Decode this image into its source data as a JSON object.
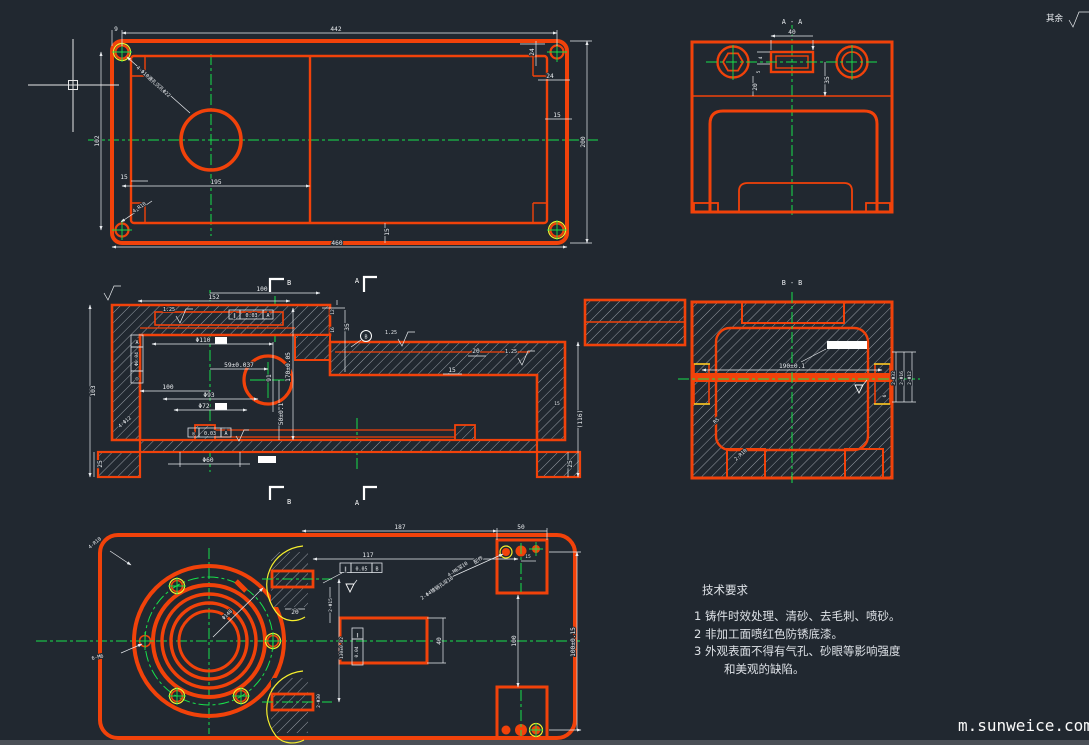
{
  "colors": {
    "background": "#212830",
    "line_orange": "#f1420a",
    "centerline_green": "#17e14b",
    "highlight_yellow": "#f6ef2d",
    "dimension_white": "#e9ecef"
  },
  "corner_note": {
    "text": "其余"
  },
  "watermark": {
    "text": "m.sunweice.com"
  },
  "tech": {
    "title": "技术要求",
    "line1": "1  铸件时效处理、清砂、去毛刺、喷砂。",
    "line2": "2  非加工面喷红色防锈底漆。",
    "line3": "3  外观表面不得有气孔、砂眼等影响强度",
    "line4": "和美观的缺陷。"
  },
  "top": {
    "d442": "442",
    "d9": "9",
    "d24a": "24",
    "d24b": "24",
    "d15r": "15",
    "d200": "200",
    "d102": "102",
    "d15l": "15",
    "d195": "195",
    "d460": "460",
    "d15b": "15",
    "leader_holes": "4-Φ10通孔沉孔Φ22",
    "leader_corner": "4-R10"
  },
  "front": {
    "d100t": "100",
    "d152": "152",
    "sf1": "1.25",
    "sf2": "1.25",
    "sf3": "1.25",
    "gdt_top": {
      "sym": "∥",
      "val": "0.03",
      "ref": "A"
    },
    "gdt_left": {
      "sym": "◎",
      "val": "Φ0.04",
      "ref": "A"
    },
    "gdt_bot": {
      "sym": "◎",
      "val": "0.03",
      "ref": "A"
    },
    "d110": "Φ110",
    "d59": "59±0.037",
    "d91": "91",
    "d170": "170±0.05",
    "d100m": "100",
    "d93": "Φ93",
    "d72": "Φ72",
    "d50": "50±0.1",
    "d60": "Φ60",
    "d103": "103",
    "d25l": "25",
    "leader_left": "4-Φ12",
    "d20": "20",
    "d15": "15",
    "d116": "(116)",
    "d15s": "15",
    "d25r": "25",
    "d12": "12",
    "d16": "16",
    "d35": "35",
    "datum_b": "B",
    "mk_a": "A",
    "mk_b": "B"
  },
  "aa": {
    "title": "A - A",
    "d40": "40",
    "d35": "35",
    "d20": "20",
    "d4": "4",
    "d5": "5"
  },
  "bb": {
    "title": "B - B",
    "d190": "190±0.1",
    "dp32": "2-Φ32",
    "dp16": "2-Φ16",
    "dp12": "2-Φ12",
    "d6": "6",
    "r5": "R5",
    "r10": "2-R10"
  },
  "bottom": {
    "d187": "187",
    "d117": "117",
    "d50": "50",
    "d15a": "15",
    "d15b": "15",
    "d100": "100",
    "d100t": "100±0.15",
    "d40": "40",
    "d20": "20",
    "dp15": "2-Φ15",
    "d130": "130±0.02",
    "dp30": "2-Φ30",
    "d148": "Φ148",
    "lead_bc": "6-M6",
    "lead_r": "4-R10",
    "lead_m6": "4-M6深10",
    "lead_pin": "2-Φ4锥销孔深10",
    "lead_pin_hl": "配作",
    "gdt1": {
      "sym": "∥",
      "val": "0.05",
      "ref": "B"
    },
    "gdt2": {
      "sym": "∥",
      "val": "0.04"
    }
  }
}
